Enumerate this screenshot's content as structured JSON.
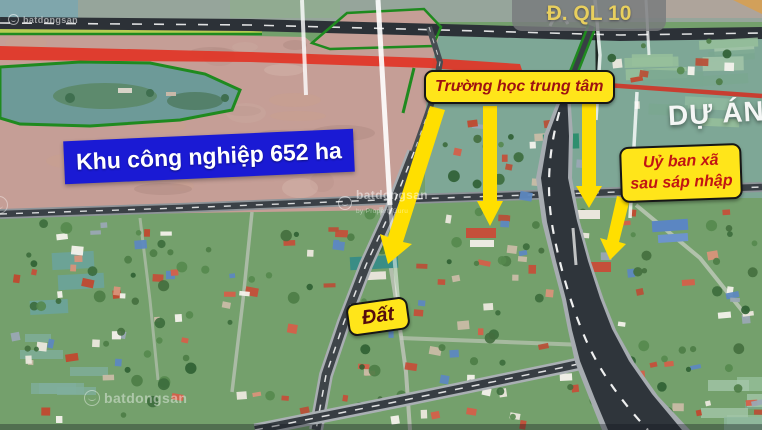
{
  "annotations": {
    "highway_label": "Đ. QL 10",
    "school_label": "Trường học trung tâm",
    "committee_label_line1": "Uỷ ban xã",
    "committee_label_line2": "sau sáp nhập",
    "industrial_label": "Khu công nghiệp 652 ha",
    "land_label": "Đất",
    "project_label": "DỰ ÁN Đ"
  },
  "watermark": {
    "brand": "batdongsan",
    "byline": "by PropertyGuru"
  },
  "colors": {
    "annotation_box_yellow": "#ffe51a",
    "annotation_text_red": "#a81212",
    "industrial_box_blue": "#1a1ad4",
    "highway_label_text": "#e8cf5e",
    "boundary_green": "#1f8a1f",
    "road_highlight_red": "#e13526",
    "arrow_yellow": "#ffdf00"
  }
}
